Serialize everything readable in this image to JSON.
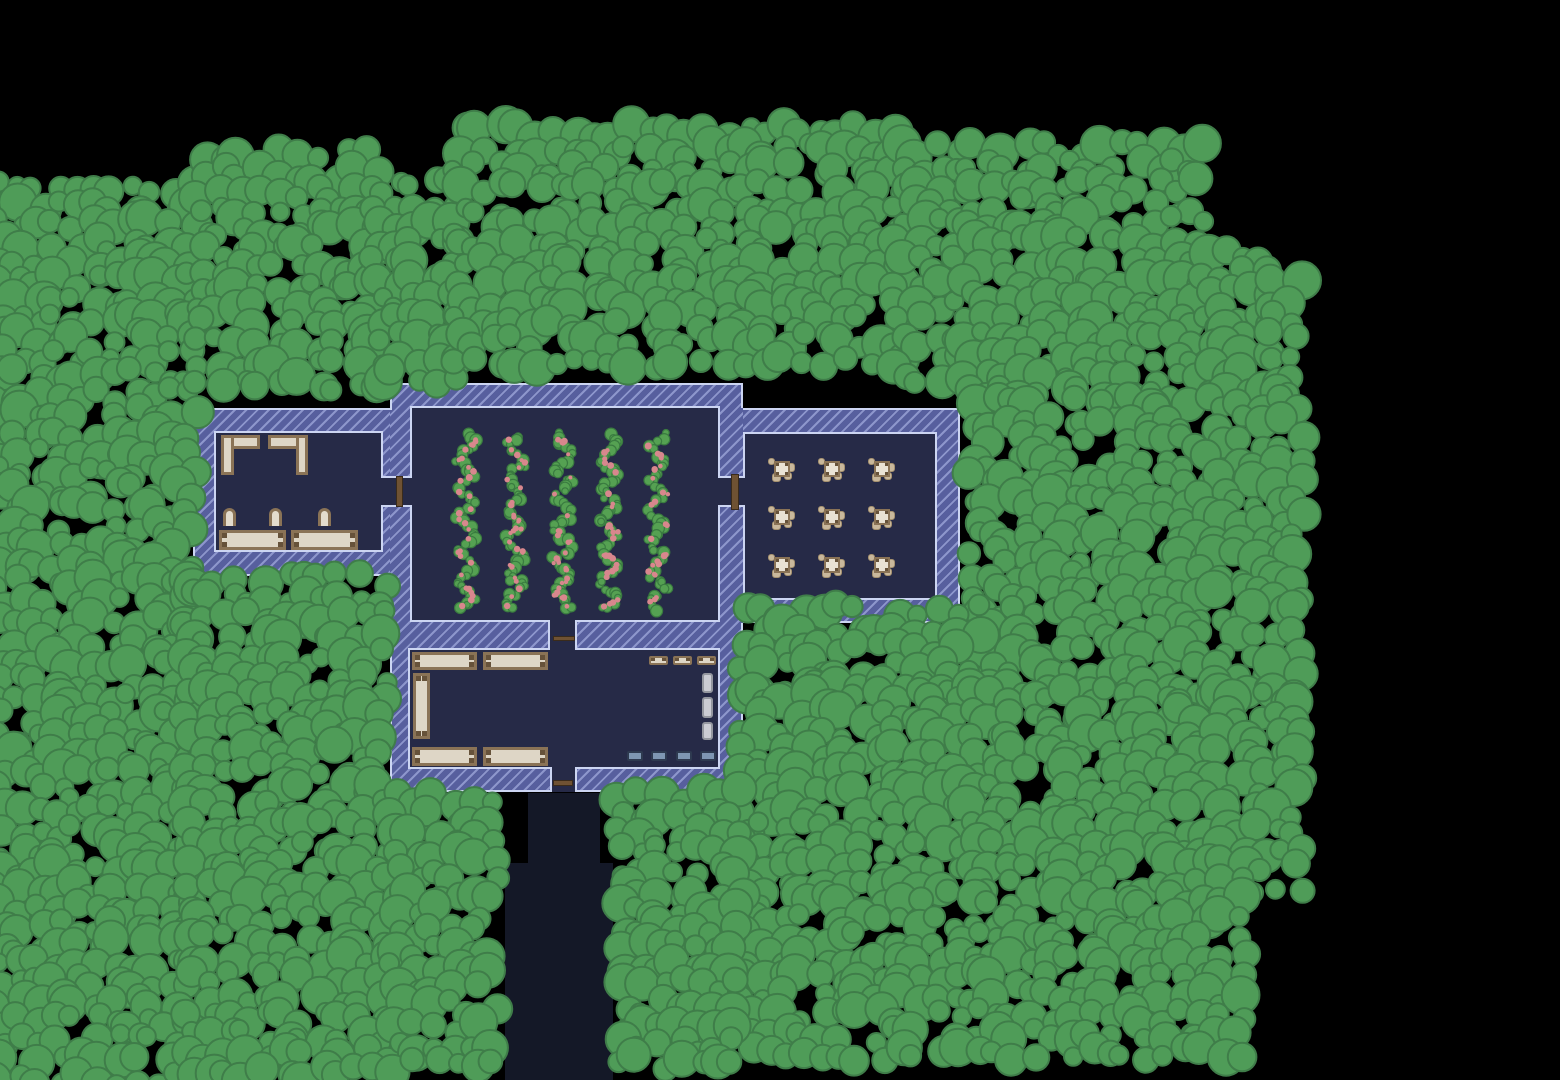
{
  "scene": {
    "width": 1560,
    "height": 1080,
    "seed": 20240615
  },
  "palette": {
    "background": "#000000",
    "path": "#141827",
    "wall_base": "#575f9e",
    "wall_stripe": "#8d96cc",
    "wall_outline": "#ccd5f2",
    "floor": "#262a47",
    "tree_fill": "#4f9c58",
    "tree_stroke": "#3f7d49",
    "crop_leaf": "#55a152",
    "crop_leaf_stroke": "#3a7b40",
    "crop_berry": "#d8878d",
    "wood_beige": "#ded6c6",
    "wood_brown": "#8a7356",
    "wood_post": "#66523a",
    "chair_fill": "#e3dccd",
    "table_top": "#e9e2d4",
    "chair_nub": "#c9b89c",
    "chair_nub_edge": "#a5916f",
    "locker_fill": "#cbccd3",
    "locker_border": "#94979f",
    "chest_fill": "#7e96b2",
    "chest_border": "#2e3a50",
    "door_fill": "#6f5233",
    "door_border": "#3a2b1b"
  },
  "paths": [
    {
      "name": "south-path-upper",
      "rect": [
        528,
        793,
        72,
        70
      ]
    },
    {
      "name": "south-path-lower",
      "rect": [
        505,
        863,
        108,
        217
      ]
    }
  ],
  "building": {
    "walls": [
      {
        "name": "west-wing-wall",
        "rect": [
          193,
          408,
          197,
          168
        ]
      },
      {
        "name": "central-wall",
        "rect": [
          390,
          383,
          353,
          409
        ]
      },
      {
        "name": "east-wing-wall",
        "rect": [
          743,
          408,
          217,
          215
        ]
      }
    ],
    "outline": [
      [
        390,
        383,
        353,
        2
      ],
      [
        741,
        383,
        2,
        25
      ],
      [
        743,
        408,
        217,
        2
      ],
      [
        958,
        408,
        2,
        215
      ],
      [
        743,
        621,
        217,
        2
      ],
      [
        741,
        623,
        2,
        169
      ],
      [
        390,
        790,
        160,
        2
      ],
      [
        577,
        790,
        166,
        2
      ],
      [
        390,
        574,
        2,
        218
      ],
      [
        193,
        574,
        197,
        2
      ],
      [
        193,
        408,
        2,
        168
      ],
      [
        193,
        408,
        197,
        2
      ],
      [
        390,
        383,
        2,
        27
      ]
    ],
    "floors": [
      {
        "name": "west-room-floor",
        "border": "b-all",
        "rect": [
          214,
          431,
          169,
          121
        ]
      },
      {
        "name": "farm-room-floor",
        "border": "b-all",
        "rect": [
          410,
          406,
          310,
          216
        ]
      },
      {
        "name": "east-dining-floor",
        "border": "b-all",
        "rect": [
          743,
          432,
          194,
          168
        ]
      },
      {
        "name": "south-room-floor",
        "border": "b-all",
        "rect": [
          408,
          648,
          312,
          121
        ]
      },
      {
        "name": "west-doorway",
        "border": "b-tb",
        "rect": [
          381,
          476,
          31,
          31
        ]
      },
      {
        "name": "east-doorway",
        "border": "b-tb",
        "rect": [
          718,
          476,
          27,
          31
        ]
      },
      {
        "name": "south-doorway",
        "border": "b-lr",
        "rect": [
          548,
          620,
          29,
          30
        ]
      },
      {
        "name": "exit-doorway",
        "border": "b-lr",
        "rect": [
          550,
          767,
          27,
          25
        ]
      }
    ],
    "doors": [
      {
        "name": "west-door",
        "rect": [
          396,
          476,
          7,
          31
        ]
      },
      {
        "name": "east-door",
        "rect": [
          731,
          474,
          8,
          36
        ]
      },
      {
        "name": "south-door",
        "rect": [
          553,
          636,
          22,
          5
        ]
      },
      {
        "name": "exit-door",
        "rect": [
          553,
          780,
          20,
          6
        ]
      }
    ]
  },
  "furniture": {
    "west-room": [
      {
        "type": "counter",
        "rect": [
          221,
          435,
          39,
          14
        ]
      },
      {
        "type": "counter",
        "rect": [
          221,
          435,
          13,
          40
        ]
      },
      {
        "type": "counter",
        "rect": [
          268,
          435,
          40,
          14
        ]
      },
      {
        "type": "counter",
        "rect": [
          296,
          435,
          12,
          40
        ]
      },
      {
        "type": "chair",
        "rect": [
          223,
          508,
          13,
          18
        ]
      },
      {
        "type": "chair",
        "rect": [
          269,
          508,
          13,
          18
        ]
      },
      {
        "type": "chair",
        "rect": [
          318,
          508,
          13,
          18
        ]
      },
      {
        "type": "table",
        "rect": [
          219,
          530,
          67,
          20
        ]
      },
      {
        "type": "table",
        "rect": [
          291,
          530,
          67,
          20
        ]
      }
    ],
    "south-room": [
      {
        "type": "table",
        "rect": [
          412,
          652,
          65,
          18
        ]
      },
      {
        "type": "table",
        "rect": [
          483,
          652,
          65,
          18
        ]
      },
      {
        "type": "table",
        "rect": [
          413,
          673,
          17,
          66
        ]
      },
      {
        "type": "table",
        "rect": [
          412,
          747,
          65,
          19
        ]
      },
      {
        "type": "table",
        "rect": [
          483,
          747,
          65,
          19
        ]
      },
      {
        "type": "small-table",
        "rect": [
          649,
          656,
          19,
          9
        ]
      },
      {
        "type": "small-table",
        "rect": [
          673,
          656,
          19,
          9
        ]
      },
      {
        "type": "small-table",
        "rect": [
          697,
          656,
          19,
          9
        ]
      },
      {
        "type": "locker",
        "rect": [
          702,
          673,
          11,
          20
        ]
      },
      {
        "type": "locker",
        "rect": [
          702,
          697,
          11,
          21
        ]
      },
      {
        "type": "locker",
        "rect": [
          702,
          722,
          11,
          18
        ]
      },
      {
        "type": "chest",
        "rect": [
          627,
          751,
          16,
          10
        ]
      },
      {
        "type": "chest",
        "rect": [
          651,
          751,
          16,
          10
        ]
      },
      {
        "type": "chest",
        "rect": [
          676,
          751,
          16,
          10
        ]
      },
      {
        "type": "chest",
        "rect": [
          700,
          751,
          16,
          10
        ]
      }
    ]
  },
  "dining": {
    "cols": [
      782,
      832,
      882
    ],
    "rows": [
      469,
      517,
      565
    ],
    "unit": 26,
    "table": 16,
    "chairs": [
      [
        -11,
        -8,
        7
      ],
      [
        8,
        -2,
        9
      ],
      [
        -6,
        8,
        9
      ],
      [
        6,
        7,
        8
      ]
    ]
  },
  "crops": {
    "columns": [
      466,
      515,
      563,
      609,
      658
    ],
    "top": 432,
    "bottom": 612,
    "greens_per_column": 58,
    "berries_per_column": 30
  },
  "tree_regions": [
    [
      0,
      186,
      192,
      1080
    ],
    [
      202,
      155,
      378,
      388
    ],
    [
      377,
      186,
      462,
      384
    ],
    [
      460,
      132,
      900,
      376
    ],
    [
      900,
      150,
      968,
      380
    ],
    [
      968,
      148,
      1210,
      404
    ],
    [
      1208,
      256,
      1278,
      404
    ],
    [
      1276,
      282,
      1306,
      404
    ],
    [
      974,
      404,
      1306,
      696
    ],
    [
      746,
      612,
      976,
      698
    ],
    [
      746,
      696,
      1300,
      902
    ],
    [
      746,
      902,
      1256,
      1068
    ],
    [
      622,
      796,
      748,
      1080
    ],
    [
      190,
      580,
      398,
      1080
    ],
    [
      396,
      798,
      508,
      1080
    ]
  ],
  "tree_params": {
    "step": 19,
    "r_min": 9,
    "r_max": 19,
    "jitter": 8,
    "skip": 0.05
  }
}
